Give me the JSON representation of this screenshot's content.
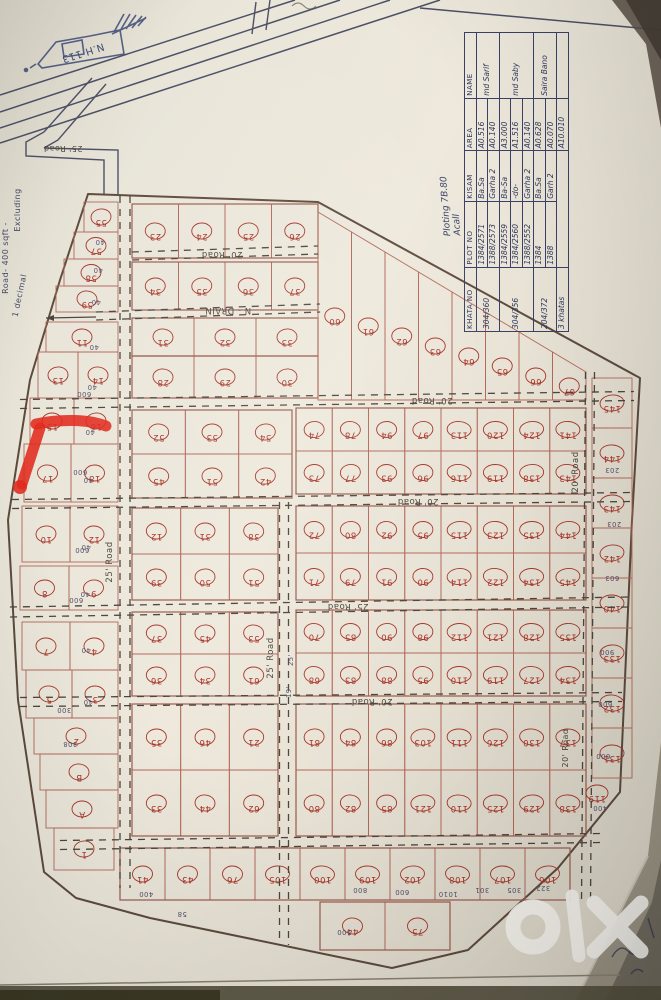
{
  "watermark": {
    "text": "OLX"
  },
  "table": {
    "note_line1": "Ploting 7B.80",
    "note_line2": "Acall",
    "headers": [
      "KHATA NO",
      "PLOT NO",
      "KISAM",
      "AREA",
      "NAME"
    ],
    "rows": [
      {
        "khata": "304/360",
        "plot": "1384/2571",
        "kisam": "Ba.Sa",
        "area": "A0.516",
        "name": "md Sarif"
      },
      {
        "plot": "1388/2573",
        "kisam": "Garha 2",
        "area": "A0.140"
      },
      {
        "khata": "304/356",
        "plot": "1384/2559",
        "kisam": "Ba-Sa",
        "area": "A3.000",
        "name": "md Saby"
      },
      {
        "plot": "1384/2560",
        "kisam": "-do-",
        "area": "A1.516"
      },
      {
        "plot": "1388/2552",
        "kisam": "Garha 2",
        "area": "A0.140"
      },
      {
        "khata": "204/372",
        "plot": "1384",
        "kisam": "Ba.Sa",
        "area": "A0.628",
        "name": "Saira Bano"
      },
      {
        "plot": "1388",
        "kisam": "Garh 2",
        "area": "A0.070"
      },
      {
        "khata": "3 khatas",
        "area": "A10.010"
      }
    ]
  },
  "map": {
    "colors": {
      "line": "#b2685a",
      "blockline": "#9b5b4e",
      "red": "#a8352a",
      "ink": "#3a4166",
      "road": "#4c463c",
      "boundary": "#5d4b3d",
      "marker": "#e12a1d",
      "dim": "#55506a",
      "blue": "#3d4a77"
    },
    "boundary": [
      [
        88,
        194
      ],
      [
        318,
        202
      ],
      [
        640,
        378
      ],
      [
        632,
        520
      ],
      [
        620,
        792
      ],
      [
        558,
        868
      ],
      [
        468,
        950
      ],
      [
        392,
        968
      ],
      [
        150,
        918
      ],
      [
        76,
        898
      ],
      [
        44,
        872
      ],
      [
        18,
        700
      ],
      [
        8,
        520
      ],
      [
        30,
        380
      ],
      [
        60,
        280
      ]
    ],
    "highway": {
      "lines": [
        [
          0,
          95,
          295,
          0
        ],
        [
          0,
          112,
          340,
          0
        ],
        [
          0,
          128,
          390,
          0
        ],
        [
          0,
          143,
          440,
          0
        ],
        [
          420,
          8,
          661,
          30
        ]
      ]
    },
    "connector": {
      "paths": [
        "M92,78 L44,132 L26,142 L26,156 L104,160 L104,194",
        "M106,84 L58,140 L44,148",
        "M44,148 L118,150 L118,194",
        "M256,2 L252,34",
        "M270,0 L266,30"
      ]
    },
    "roads": [
      {
        "p": [
          132,
          256,
          318,
          250
        ],
        "w": 8,
        "t": "20' Road",
        "lx": 222,
        "ly": 252,
        "lr": 180
      },
      {
        "p": [
          96,
          316,
          320,
          308
        ],
        "w": 8,
        "t": "N - DRAIN",
        "lx": 228,
        "ly": 308,
        "lr": 180
      },
      {
        "p": [
          20,
          404,
          634,
          396
        ],
        "w": 9,
        "t": "20' Road",
        "lx": 432,
        "ly": 398,
        "lr": 180
      },
      {
        "p": [
          12,
          504,
          632,
          497
        ],
        "w": 9,
        "t": "20' Road",
        "lx": 418,
        "ly": 499,
        "lr": 180
      },
      {
        "p": [
          10,
          612,
          628,
          602
        ],
        "w": 10,
        "t": "25' Road",
        "lx": 348,
        "ly": 604,
        "lr": 180
      },
      {
        "p": [
          20,
          702,
          622,
          697
        ],
        "w": 9,
        "t": "20' Road",
        "lx": 372,
        "ly": 699,
        "lr": 180
      },
      {
        "p": [
          60,
          845,
          600,
          838
        ],
        "w": 9
      },
      {
        "p": [
          125,
          196,
          125,
          888
        ],
        "w": 10,
        "t": "25' Road",
        "lx": 112,
        "ly": 562,
        "lr": -90
      },
      {
        "p": [
          284,
          502,
          284,
          945
        ],
        "w": 9,
        "t": "25' Road",
        "lx": 273,
        "ly": 658,
        "lr": -90
      },
      {
        "p": [
          590,
          372,
          586,
          902
        ],
        "w": 9,
        "t": "20' Road",
        "lx": 578,
        "ly": 472,
        "lr": -90
      }
    ],
    "labels": [
      {
        "t": "N.H 113",
        "x": 82,
        "y": 50,
        "r": 162,
        "s": 10,
        "c": "#3d4a77"
      },
      {
        "t": "25' Road",
        "x": 63,
        "y": 146,
        "r": 180,
        "s": 8,
        "c": "#4c463c"
      },
      {
        "t": "20' Road",
        "x": 568,
        "y": 748,
        "r": -90,
        "s": 8,
        "c": "#4c463c"
      },
      {
        "t": "Road- 400 sqft -",
        "x": 8,
        "y": 258,
        "r": -90,
        "s": 8,
        "c": "#454a66"
      },
      {
        "t": "Excluding",
        "x": 20,
        "y": 210,
        "r": -90,
        "s": 8,
        "c": "#454a66"
      },
      {
        "t": "1 decimal",
        "x": 22,
        "y": 296,
        "r": -78,
        "s": 8,
        "c": "#454a66"
      }
    ],
    "lrows": [
      {
        "x": 84,
        "y": 202,
        "w": 34,
        "h": 30,
        "ns": [
          "55"
        ]
      },
      {
        "x": 74,
        "y": 232,
        "w": 44,
        "h": 27,
        "ns": [
          "57"
        ]
      },
      {
        "x": 64,
        "y": 259,
        "w": 54,
        "h": 27,
        "ns": [
          "58"
        ]
      },
      {
        "x": 56,
        "y": 286,
        "w": 62,
        "h": 26,
        "ns": [
          "59"
        ]
      },
      {
        "x": 46,
        "y": 322,
        "w": 72,
        "h": 30,
        "ns": [
          "11"
        ]
      },
      {
        "x": 38,
        "y": 352,
        "w": 80,
        "h": 46,
        "ns": [
          "13",
          "14"
        ]
      },
      {
        "x": 30,
        "y": 398,
        "w": 88,
        "h": 46,
        "ns": [
          "15",
          "16"
        ]
      },
      {
        "x": 24,
        "y": 444,
        "w": 94,
        "h": 58,
        "ns": [
          "17",
          "18"
        ]
      },
      {
        "x": 22,
        "y": 506,
        "w": 96,
        "h": 56,
        "ns": [
          "10",
          "12"
        ]
      },
      {
        "x": 20,
        "y": 566,
        "w": 98,
        "h": 44,
        "ns": [
          "8",
          "9"
        ]
      },
      {
        "x": 22,
        "y": 622,
        "w": 96,
        "h": 48,
        "ns": [
          "7",
          "4"
        ]
      },
      {
        "x": 26,
        "y": 670,
        "w": 92,
        "h": 48,
        "ns": [
          "5",
          "3"
        ]
      },
      {
        "x": 34,
        "y": 718,
        "w": 84,
        "h": 36,
        "ns": [
          "2"
        ]
      },
      {
        "x": 40,
        "y": 754,
        "w": 78,
        "h": 36,
        "ns": [
          "B"
        ]
      },
      {
        "x": 46,
        "y": 790,
        "w": 72,
        "h": 38,
        "ns": [
          "A"
        ]
      },
      {
        "x": 54,
        "y": 828,
        "w": 60,
        "h": 42,
        "ns": [
          "1"
        ]
      }
    ],
    "blocks": [
      {
        "x": 132,
        "y": 204,
        "w": 186,
        "h": 54,
        "rows": [
          [
            "23",
            "24",
            "25",
            "26"
          ]
        ]
      },
      {
        "x": 132,
        "y": 262,
        "w": 186,
        "h": 48,
        "rows": [
          [
            "34",
            "35",
            "36",
            "37"
          ]
        ]
      },
      {
        "x": 132,
        "y": 318,
        "w": 186,
        "h": 38,
        "rows": [
          [
            "31",
            "32",
            "33"
          ]
        ]
      },
      {
        "x": 132,
        "y": 356,
        "w": 186,
        "h": 42,
        "rows": [
          [
            "28",
            "29",
            "30"
          ]
        ]
      },
      {
        "x": 132,
        "y": 410,
        "w": 160,
        "h": 88,
        "rows": [
          [
            "52",
            "53",
            "54"
          ],
          [
            "45",
            "51",
            "42"
          ]
        ]
      },
      {
        "x": 132,
        "y": 508,
        "w": 146,
        "h": 92,
        "rows": [
          [
            "12",
            "31",
            "38"
          ],
          [
            "39",
            "50",
            "51"
          ]
        ]
      },
      {
        "x": 132,
        "y": 612,
        "w": 146,
        "h": 84,
        "rows": [
          [
            "37",
            "45",
            "53"
          ],
          [
            "36",
            "34",
            "61"
          ]
        ]
      },
      {
        "x": 132,
        "y": 704,
        "w": 146,
        "h": 132,
        "rows": [
          [
            "35",
            "46",
            "21"
          ],
          [
            "33",
            "44",
            "62"
          ]
        ]
      },
      {
        "x": 296,
        "y": 408,
        "w": 290,
        "h": 86,
        "rows": [
          [
            "74",
            "78",
            "94",
            "97",
            "113",
            "120",
            "124",
            "141"
          ],
          [
            "73",
            "77",
            "93",
            "96",
            "116",
            "119",
            "138",
            "143"
          ]
        ]
      },
      {
        "x": 296,
        "y": 506,
        "w": 290,
        "h": 94,
        "rows": [
          [
            "72",
            "80",
            "92",
            "95",
            "115",
            "123",
            "135",
            "144"
          ],
          [
            "71",
            "79",
            "91",
            "90",
            "114",
            "122",
            "134",
            "145"
          ]
        ]
      },
      {
        "x": 296,
        "y": 610,
        "w": 290,
        "h": 86,
        "rows": [
          [
            "70",
            "85",
            "90",
            "98",
            "112",
            "121",
            "128",
            "135"
          ],
          [
            "68",
            "83",
            "88",
            "95",
            "110",
            "119",
            "127",
            "134"
          ]
        ]
      },
      {
        "x": 296,
        "y": 704,
        "w": 290,
        "h": 132,
        "rows": [
          [
            "81",
            "84",
            "86",
            "103",
            "111",
            "126",
            "130",
            "137"
          ],
          [
            "80",
            "82",
            "85",
            "121",
            "110",
            "125",
            "129",
            "138"
          ]
        ]
      },
      {
        "x": 120,
        "y": 848,
        "w": 450,
        "h": 52,
        "rows": [
          [
            "41",
            "43",
            "76",
            "105",
            "100",
            "109",
            "102",
            "108",
            "107",
            "106"
          ]
        ]
      },
      {
        "x": 320,
        "y": 902,
        "w": 130,
        "h": 48,
        "rows": [
          [
            "44",
            "75"
          ]
        ]
      }
    ],
    "diag": {
      "x": 318,
      "w": 268,
      "yTopStart": 212,
      "yTopEnd": 372,
      "yBottom": 400,
      "ns": [
        "60",
        "61",
        "62",
        "63",
        "64",
        "65",
        "66",
        "67"
      ]
    },
    "rc": {
      "x": 592,
      "w": 40,
      "y": 378,
      "h": 50,
      "ns": [
        "145",
        "144",
        "143",
        "142",
        "140",
        "133",
        "132",
        "131"
      ]
    },
    "orphans": [
      {
        "n": "119",
        "x": 597,
        "y": 793
      }
    ],
    "dims": [
      [
        100,
        240,
        "40",
        180
      ],
      [
        98,
        268,
        "40",
        180
      ],
      [
        96,
        300,
        "40",
        180
      ],
      [
        94,
        345,
        "40",
        180
      ],
      [
        92,
        385,
        "40",
        180
      ],
      [
        90,
        430,
        "40",
        180
      ],
      [
        88,
        478,
        "40",
        180
      ],
      [
        86,
        545,
        "40",
        180
      ],
      [
        85,
        592,
        "40",
        180
      ],
      [
        86,
        648,
        "40",
        180
      ],
      [
        88,
        700,
        "40",
        180
      ],
      [
        84,
        392,
        "600",
        180
      ],
      [
        80,
        470,
        "600",
        180
      ],
      [
        82,
        548,
        "600",
        180
      ],
      [
        76,
        598,
        "600",
        180
      ],
      [
        64,
        708,
        "300",
        180
      ],
      [
        70,
        742,
        "308",
        180
      ],
      [
        360,
        888,
        "800",
        180
      ],
      [
        402,
        890,
        "600",
        180
      ],
      [
        448,
        892,
        "1010",
        180
      ],
      [
        482,
        888,
        "301",
        180
      ],
      [
        514,
        888,
        "305",
        180
      ],
      [
        543,
        886,
        "322",
        180
      ],
      [
        344,
        930,
        "500",
        180
      ],
      [
        146,
        892,
        "400",
        180
      ],
      [
        182,
        912,
        "58",
        180
      ],
      [
        612,
        468,
        "203",
        180
      ],
      [
        614,
        522,
        "203",
        180
      ],
      [
        612,
        576,
        "603",
        180
      ],
      [
        607,
        650,
        "900",
        180
      ],
      [
        605,
        702,
        "600",
        180
      ],
      [
        603,
        754,
        "600",
        180
      ],
      [
        600,
        806,
        "400",
        180
      ],
      [
        293,
        660,
        "25'",
        -90
      ],
      [
        291,
        692,
        "19'",
        -90
      ]
    ],
    "drain_arrow": {
      "from": [
        96,
        317
      ],
      "to": [
        46,
        318
      ]
    },
    "redmark": {
      "paths": [
        "M36,424 C60,419 88,419 106,426",
        "M40,428 L22,484"
      ],
      "dot": [
        20,
        487
      ]
    }
  }
}
